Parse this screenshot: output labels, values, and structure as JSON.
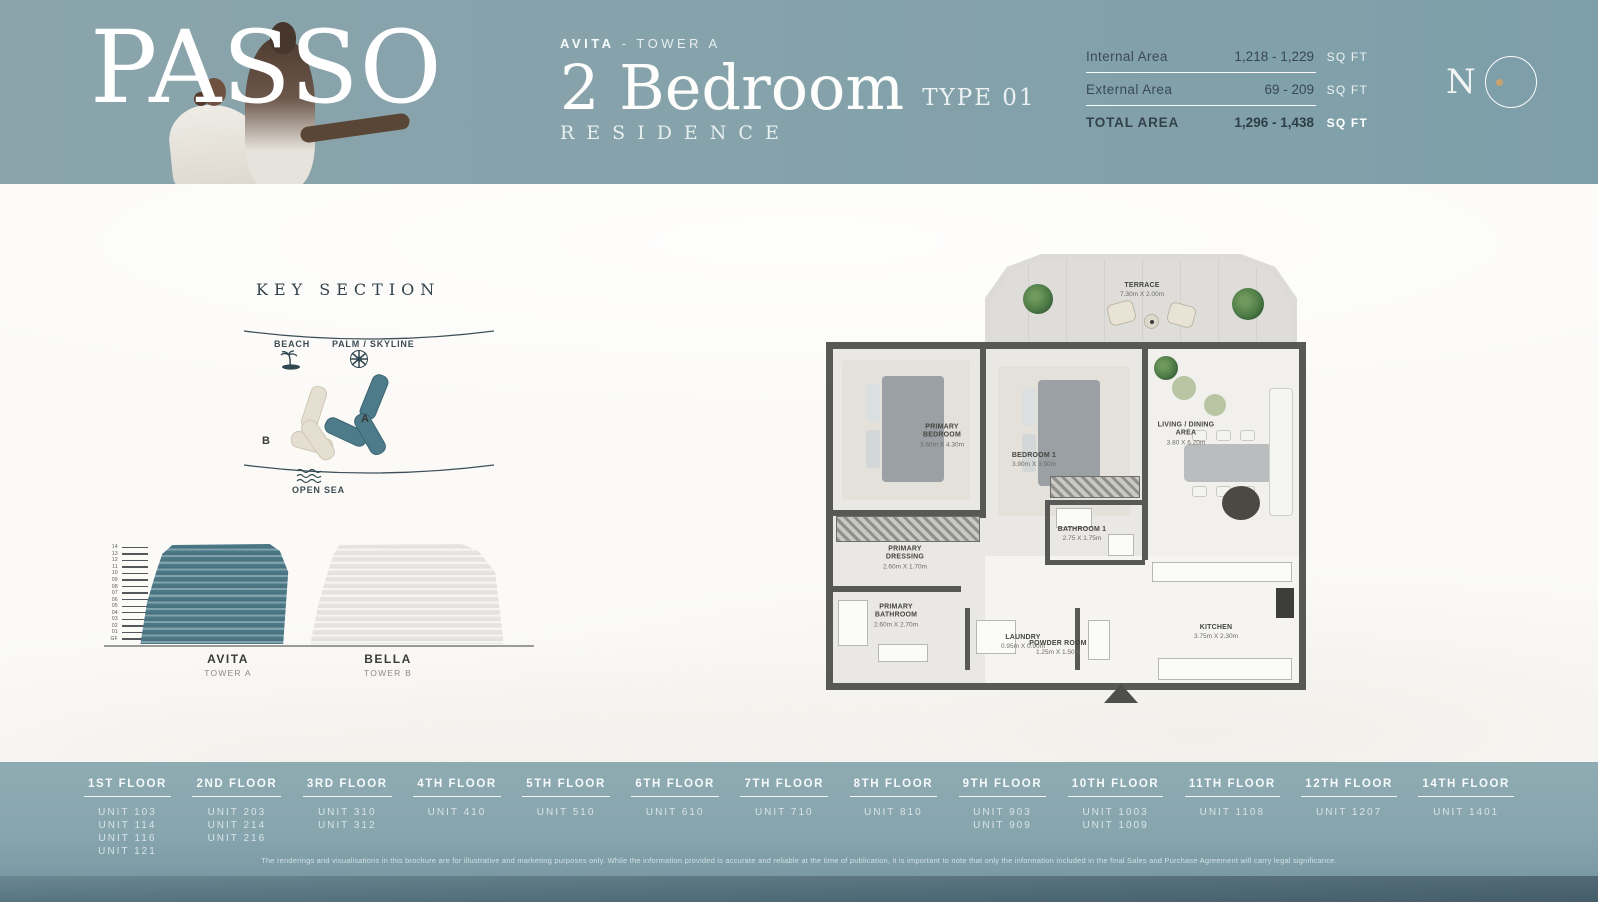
{
  "header": {
    "brand": "PASSO",
    "project_bold": "AVITA",
    "project_rest": "- TOWER A",
    "unit_type": "2 Bedroom",
    "type_label": "TYPE 01",
    "residence_label": "RESIDENCE",
    "developer_initial": "N",
    "areas": [
      {
        "label": "Internal Area",
        "value": "1,218 - 1,229",
        "unit": "SQ FT"
      },
      {
        "label": "External Area",
        "value": "69 - 209",
        "unit": "SQ FT"
      },
      {
        "label": "TOTAL AREA",
        "value": "1,296 - 1,438",
        "unit": "SQ FT"
      }
    ]
  },
  "key_section": {
    "title": "KEY SECTION",
    "beach_label": "BEACH",
    "palm_label": "PALM / SKYLINE",
    "tower_a_label": "A",
    "tower_b_label": "B",
    "open_sea_label": "OPEN SEA"
  },
  "elevation": {
    "floors": [
      "14",
      "13",
      "12",
      "11",
      "10",
      "09",
      "08",
      "07",
      "06",
      "05",
      "04",
      "03",
      "02",
      "01",
      "GF"
    ],
    "towers": [
      {
        "name": "AVITA",
        "sub": "TOWER A"
      },
      {
        "name": "BELLA",
        "sub": "TOWER B"
      }
    ]
  },
  "floor_plan": {
    "rooms": [
      {
        "name": "TERRACE",
        "dims": "7.30m X 2.00m"
      },
      {
        "name": "PRIMARY BEDROOM",
        "dims": "3.60m X 4.30m"
      },
      {
        "name": "BEDROOM 1",
        "dims": "3.90m X 3.90m"
      },
      {
        "name": "LIVING / DINING AREA",
        "dims": "3.80 X 6.20m"
      },
      {
        "name": "PRIMARY DRESSING",
        "dims": "2.60m X 1.70m"
      },
      {
        "name": "PRIMARY BATHROOM",
        "dims": "2.60m X 2.70m"
      },
      {
        "name": "BATHROOM 1",
        "dims": "2.75 X 1.75m"
      },
      {
        "name": "LAUNDRY",
        "dims": "0.95m X 0.90m"
      },
      {
        "name": "POWDER ROOM",
        "dims": "1.25m X 1.50m"
      },
      {
        "name": "KITCHEN",
        "dims": "3.75m X 2.30m"
      }
    ]
  },
  "floors_bar": [
    {
      "label": "1ST FLOOR",
      "units": [
        "UNIT 103",
        "UNIT 114",
        "UNIT 116",
        "UNIT 121"
      ]
    },
    {
      "label": "2ND FLOOR",
      "units": [
        "UNIT 203",
        "UNIT 214",
        "UNIT 216"
      ]
    },
    {
      "label": "3RD FLOOR",
      "units": [
        "UNIT 310",
        "UNIT 312"
      ]
    },
    {
      "label": "4TH FLOOR",
      "units": [
        "UNIT 410"
      ]
    },
    {
      "label": "5TH FLOOR",
      "units": [
        "UNIT 510"
      ]
    },
    {
      "label": "6TH FLOOR",
      "units": [
        "UNIT 610"
      ]
    },
    {
      "label": "7TH FLOOR",
      "units": [
        "UNIT 710"
      ]
    },
    {
      "label": "8TH FLOOR",
      "units": [
        "UNIT 810"
      ]
    },
    {
      "label": "9TH FLOOR",
      "units": [
        "UNIT 903",
        "UNIT 909"
      ]
    },
    {
      "label": "10TH FLOOR",
      "units": [
        "UNIT 1003",
        "UNIT 1009"
      ]
    },
    {
      "label": "11TH FLOOR",
      "units": [
        "UNIT 1108"
      ]
    },
    {
      "label": "12TH FLOOR",
      "units": [
        "UNIT 1207"
      ]
    },
    {
      "label": "14TH FLOOR",
      "units": [
        "UNIT 1401"
      ]
    }
  ],
  "disclaimer": "The renderings and visualisations in this brochure are for illustrative and marketing purposes only. While the information provided is accurate and reliable at the time of publication, it is important to note that only the information included in the final Sales and Purchase Agreement will carry legal significance.",
  "colors": {
    "header_teal": "#86a2ab",
    "footer_teal": "#87a5ae",
    "tower_a_teal": "#4d7b8a",
    "tower_b_cream": "#e5dfd1",
    "dark_slate": "#3b4a52",
    "gold_dot": "#c9a36b"
  }
}
